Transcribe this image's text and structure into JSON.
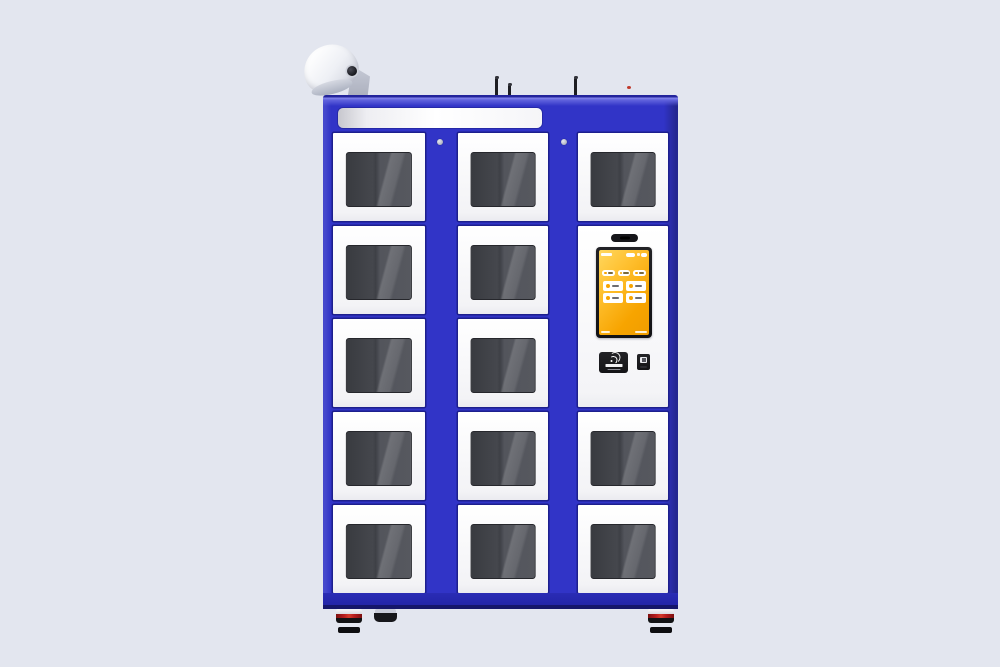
{
  "scene": {
    "subject": "blue smart locker vending machine with glass-door compartments, rooftop CCTV camera, antennas and a touchscreen kiosk column",
    "visible_text": "none legible"
  },
  "colors": {
    "bg": "#e3e6ef",
    "cabinet_blue": "#3134c7",
    "cabinet_dark": "#1d1f8e",
    "base_blue": "#2a2cb5",
    "window_dark": "#56585f",
    "screen_amber": "#f7a400",
    "reader_black": "#141417",
    "foot_red": "#b51c1c",
    "indicator_red": "#c0392b"
  },
  "cabinet": {
    "rows": 5,
    "columns": [
      {
        "name": "column-left",
        "panel": null,
        "door_count": 5
      },
      {
        "name": "column-middle",
        "panel": null,
        "door_count": 5
      },
      {
        "name": "column-right",
        "panel": {
          "row": 1,
          "span": 2
        },
        "door_count": 3
      }
    ],
    "header_sign": {
      "text": "",
      "style": "blank white strip"
    },
    "screw_count": 2
  },
  "kiosk": {
    "camera_bar_icon": "privacy-camera-bar",
    "screen": {
      "logo_mark": "white-logo-mark",
      "header_chip_count": 2,
      "quick_button_count": 3,
      "menu_button_count": 4,
      "button_icon": "orange-dot-icon"
    },
    "card_reader": {
      "icon": "contactless-card-icon",
      "label_style": "tiny white text"
    },
    "scanner_window": {
      "icon": "scanner-window-icon"
    }
  },
  "roof": {
    "cctv_camera": "white-bullet-camera",
    "antenna_count": 3,
    "indicator_dot": true
  },
  "feet": {
    "striped_feet_count": 2,
    "plain_feet_count": 1
  }
}
